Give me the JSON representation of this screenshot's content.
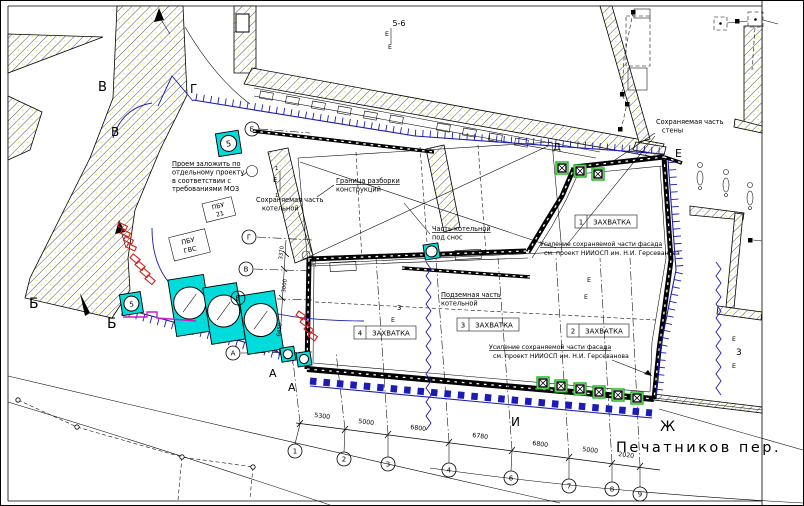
{
  "street_label": "Печатников пер.",
  "colors": {
    "cyan": "#00dcdc",
    "green": "#00b400",
    "blue": "#1c1cb4",
    "red": "#d41e1e",
    "magenta": "#c81ec8",
    "hatch_dot": "#d8d800"
  },
  "notes": {
    "opening": [
      "Проем заложить по",
      "отдельному проекту",
      "в соответствии с",
      "требованиями МОЗ"
    ],
    "kept_boiler": [
      "Сохраняемая часть",
      "котельной"
    ],
    "boundary": [
      "Граница разборки",
      "конструкций"
    ],
    "demolish": [
      "Часть котельной",
      "под снос"
    ],
    "kept_wall": [
      "Сохраняемая часть",
      "стены"
    ],
    "underground": [
      "Подземная часть",
      "котельной"
    ],
    "facade_line1": "Усиление сохраняемой части фасада",
    "facade_line2": "см. проект НИИОСП им. Н.И. Герсеванова",
    "pbu_1": [
      "ПБУ",
      "21"
    ],
    "pbu_2": [
      "ПБУ",
      "ГВС"
    ]
  },
  "zones": {
    "z1_num": "1",
    "z2_num": "2",
    "z3_num": "3",
    "z4_num": "4",
    "word": "ЗАХВАТКА"
  },
  "axes": {
    "bottom": [
      "1",
      "2",
      "3",
      "4",
      "6",
      "7",
      "8",
      "9"
    ],
    "left": [
      "Г",
      "В",
      "Б",
      "А"
    ],
    "upper_left": "Б"
  },
  "dims": {
    "bottom": [
      "5300",
      "5000",
      "6800",
      "6780",
      "6800",
      "5000",
      "2020"
    ],
    "left": [
      "3370",
      "3000",
      "6450",
      "335"
    ]
  },
  "marks": {
    "section_top": "5-6",
    "section_right": "3",
    "letter_v_top": "В",
    "letter_g_top": "Г",
    "letter_v_mid": "В",
    "letter_b_left_1": "Б",
    "letter_b_left_2": "Б",
    "letter_a_1": "А",
    "letter_a_2": "А",
    "letter_d": "Д",
    "letter_e": "Е",
    "letter_zh": "Ж",
    "letter_i": "И",
    "flag_e": "Е",
    "flag_1": "1",
    "flag_3": "3",
    "equip_num": "5"
  }
}
